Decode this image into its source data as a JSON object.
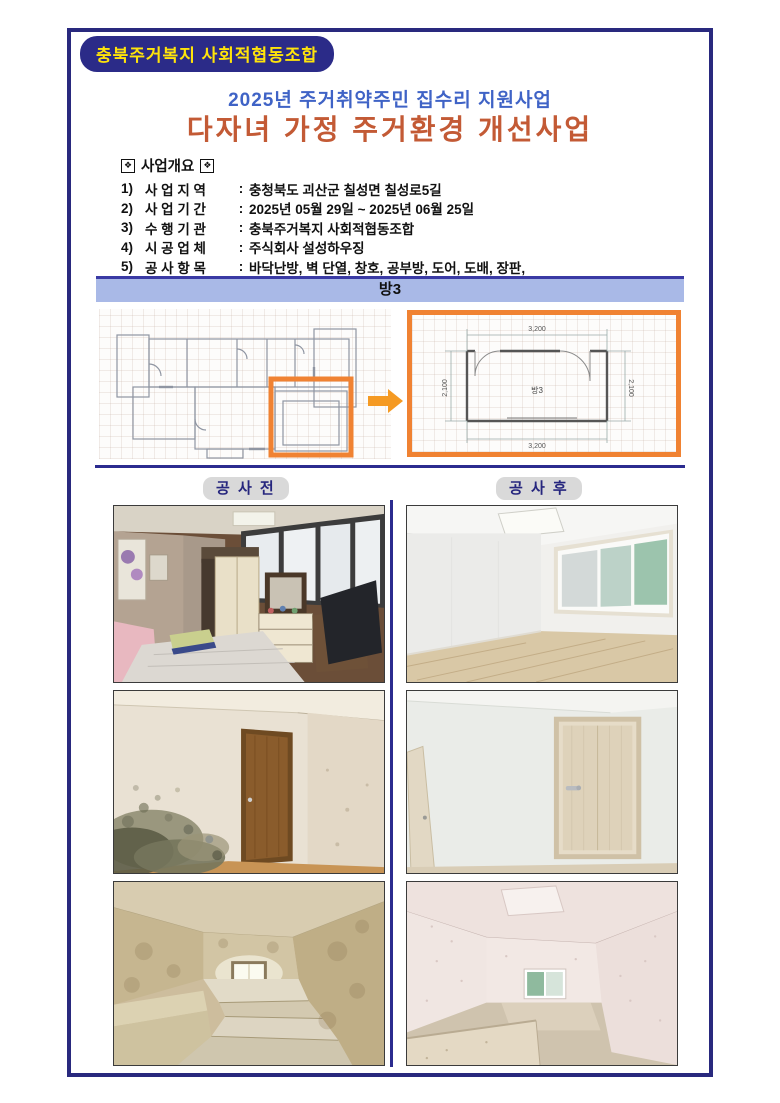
{
  "header": {
    "badge": "충북주거복지 사회적협동조합",
    "subtitle": "2025년 주거취약주민 집수리 지원사업",
    "title": "다자녀 가정 주거환경 개선사업"
  },
  "overview": {
    "icon_glyph": "❖",
    "heading": "사업개요",
    "items": [
      {
        "no": "1)",
        "label": "사 업 지 역",
        "sep": ":",
        "value": "충청북도 괴산군 칠성면 칠성로5길"
      },
      {
        "no": "2)",
        "label": "사 업 기 간",
        "sep": ":",
        "value": "2025년 05월 29일 ~ 2025년 06월 25일"
      },
      {
        "no": "3)",
        "label": "수 행 기 관",
        "sep": ":",
        "value": "충북주거복지 사회적협동조합"
      },
      {
        "no": "4)",
        "label": "시 공 업 체",
        "sep": ":",
        "value": "주식회사 설성하우징"
      },
      {
        "no": "5)",
        "label": "공 사 항 목",
        "sep": ":",
        "value": "바닥난방, 벽 단열, 창호, 공부방, 도어, 도배, 장판,"
      }
    ]
  },
  "room_banner": {
    "label": "방3"
  },
  "floorplan": {
    "room_label": "방3",
    "dim_top": "3,200",
    "dim_bottom": "3,200",
    "dim_left": "2,100",
    "dim_right": "2,100"
  },
  "photo_sections": {
    "before_label": "공 사 전",
    "after_label": "공 사 후"
  },
  "colors": {
    "navy": "#29297E",
    "badge_text_yellow": "#FFE40A",
    "subtitle_blue": "#3F63C6",
    "title_orange": "#C35A35",
    "banner_fill": "#A9B9E7",
    "highlight_orange": "#F08232",
    "label_pill_gray": "#D9D9D9"
  }
}
